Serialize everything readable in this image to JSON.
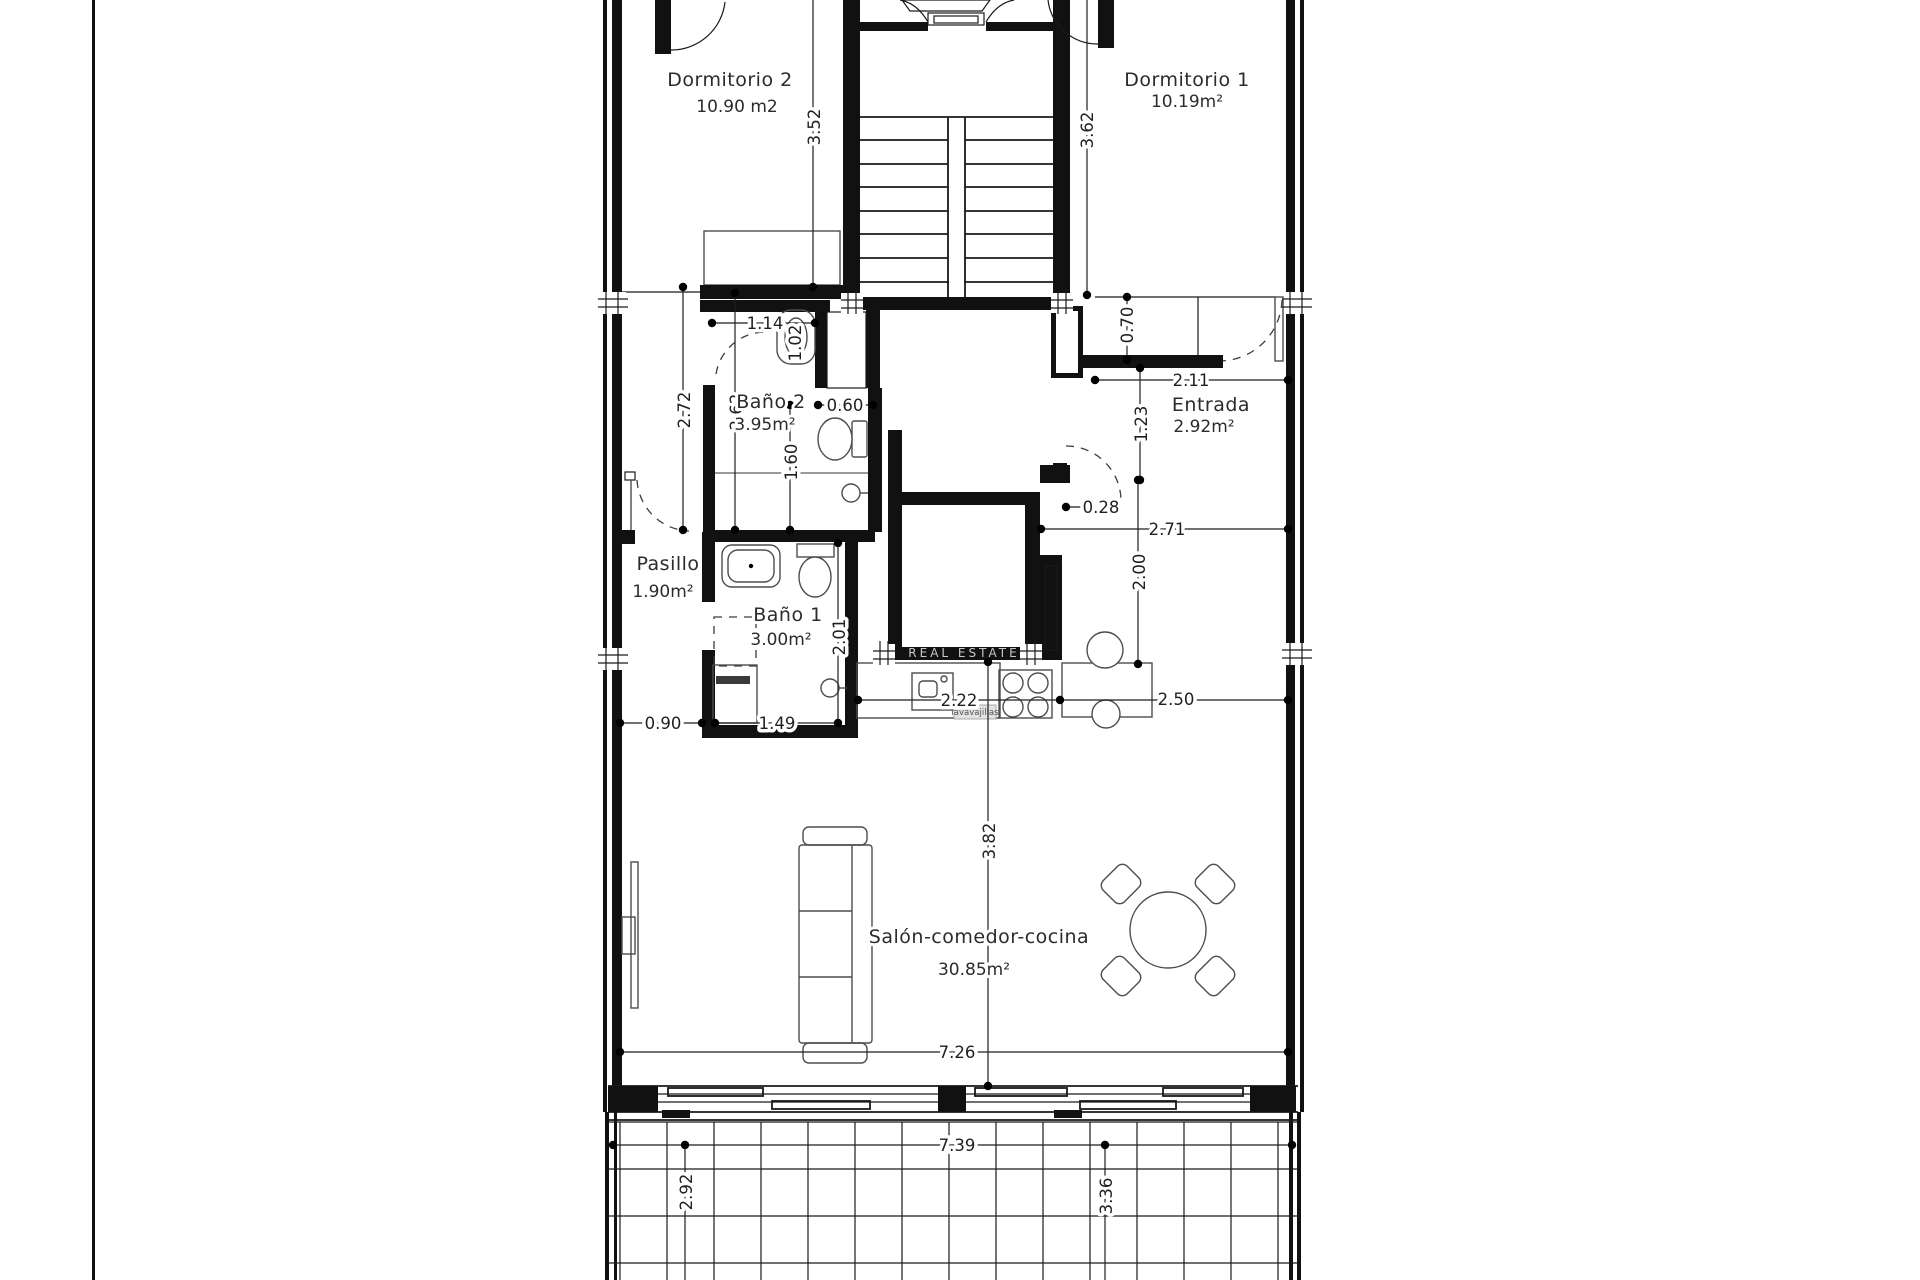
{
  "drawing": {
    "rooms": {
      "dormitorio2": {
        "label": "Dormitorio 2",
        "area": "10.90 m2"
      },
      "dormitorio1": {
        "label": "Dormitorio 1",
        "area": "10.19m²"
      },
      "bano2": {
        "label": "Baño 2",
        "area": "3.95m²"
      },
      "pasillo": {
        "label": "Pasillo",
        "area": "1.90m²"
      },
      "bano1": {
        "label": "Baño 1",
        "area": "3.00m²"
      },
      "entrada": {
        "label": "Entrada",
        "area": "2.92m²"
      },
      "salon": {
        "label": "Salón-comedor-cocina",
        "area": "30.85m²"
      }
    },
    "dimensions": {
      "dorm2_height": "3.52",
      "dorm1_height": "3.62",
      "hall_top_width": "1.14",
      "top_door_width": "1.02",
      "pasillo_height": "2.72",
      "bano2_height": "2.62",
      "wc_niche_width": "0.60",
      "bano2_lower_height": "1.60",
      "entrada_width": "2.11",
      "niche_depth": "0.70",
      "entrada_door_height": "1.23",
      "wall_offset": "0.28",
      "hall_width": "2.71",
      "kitchen_drop": "2.00",
      "counter_left_width": "2.22",
      "counter_right_width": "2.50",
      "bano1_left_offset": "0.90",
      "bano1_width": "1.49",
      "bano1_height": "2.01",
      "salon_height": "3.82",
      "salon_width": "7.26",
      "terrace_width": "7.39",
      "terrace_left_depth": "2.92",
      "terrace_depth": "3.36"
    },
    "annotations": {
      "watermark": "REAL ESTATE",
      "dishwasher_label": "lavavajillas"
    },
    "colors": {
      "wall": "#111111",
      "line": "#1a1a1a",
      "fixture": "#4d4d4d",
      "text": "#2b2b2b",
      "watermark": "#c8c8c8",
      "background": "#ffffff"
    }
  }
}
